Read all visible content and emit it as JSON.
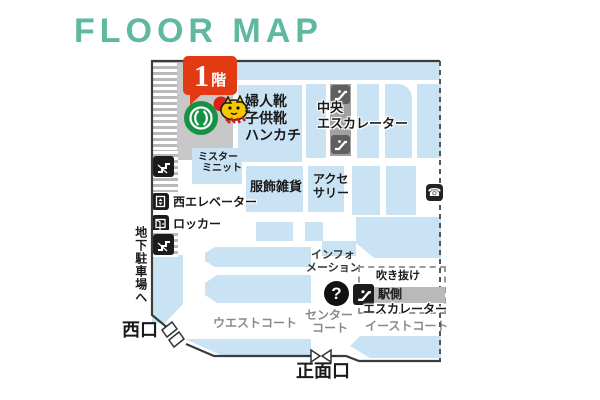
{
  "page": {
    "title": "FLOOR MAP"
  },
  "badge": {
    "number": "1",
    "unit": "階"
  },
  "areas": {
    "womens_shoes": {
      "lines": [
        "婦人靴",
        "子供靴",
        "ハンカチ"
      ]
    },
    "mister_minit": {
      "lines": [
        "ミスター",
        "ミニット"
      ]
    },
    "central_escalator": {
      "lines": [
        "中央",
        "エスカレーター"
      ]
    },
    "fashion_goods": {
      "label": "服飾雑貨"
    },
    "accessories": {
      "lines": [
        "アクセ",
        "サリー"
      ]
    },
    "west_elevator": {
      "label": "西エレベーター"
    },
    "locker": {
      "label": "ロッカー"
    },
    "information": {
      "lines": [
        "インフォ",
        "メーション"
      ]
    },
    "atrium": {
      "label": "吹き抜け"
    },
    "station_escalator": {
      "lines": [
        "駅側",
        "エスカレーター"
      ]
    },
    "west_court": {
      "label": "ウエストコート"
    },
    "center_court": {
      "lines": [
        "センター",
        "コート"
      ]
    },
    "east_court": {
      "label": "イーストコート"
    },
    "underground_parking": {
      "label": "地下駐車場へ"
    },
    "west_exit": {
      "label": "西口"
    },
    "main_entrance": {
      "label": "正面口"
    }
  },
  "icons": {
    "question": "?",
    "phone": "☎"
  },
  "colors": {
    "accent_teal": "#5fb8a0",
    "badge_red": "#e23a12",
    "area_blue": "#c9e3f4",
    "gray_block": "#c8c8c8",
    "logo_green": "#169245",
    "wall": "#3c3c3c",
    "court_gray": "#8a8a8a"
  }
}
